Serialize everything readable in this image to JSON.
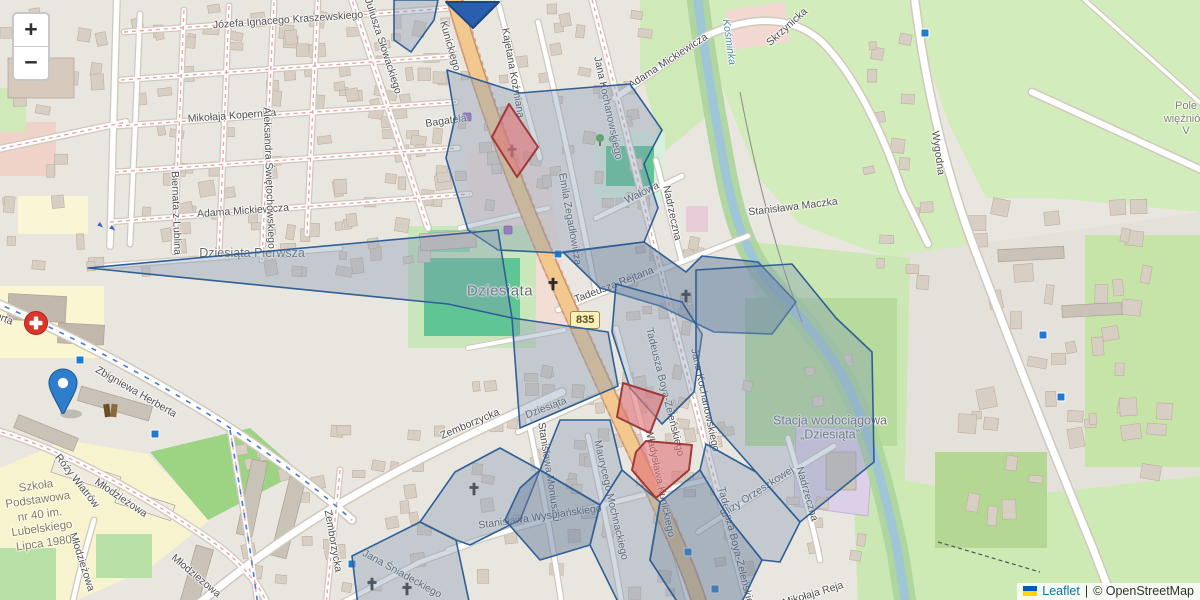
{
  "controls": {
    "zoom_in": "+",
    "zoom_out": "−"
  },
  "attribution": {
    "leaflet": "Leaflet",
    "separator": "|",
    "osm": "© OpenStreetMap"
  },
  "roads": {
    "shield_ref": "835"
  },
  "colors": {
    "overlay_stroke": "#2f5f96",
    "overlay_fill": "rgba(133,156,182,0.38)",
    "overlay_fill_dark": "rgba(104,128,158,0.5)",
    "red_stroke": "#a03a3a",
    "red_fill": "rgba(224,118,122,0.62)",
    "marker": "#2e7ecb",
    "arrow": "#2a5fae",
    "bus": "#1f7ad1"
  },
  "map_labels": [
    {
      "n": "street-kraszewskiego",
      "t": "Józefa Ignacego Kraszewskiego",
      "x": 288,
      "y": 20,
      "r": -4,
      "c": "st"
    },
    {
      "n": "street-kopernika",
      "t": "Mikołaja Kopernika",
      "x": 232,
      "y": 116,
      "r": -4,
      "c": "st"
    },
    {
      "n": "street-slowackiego",
      "t": "Juliusza Słowackiego",
      "x": 383,
      "y": 46,
      "r": 72,
      "c": "st"
    },
    {
      "n": "street-mickiewicza-w",
      "t": "Adama Mickiewicza",
      "x": 243,
      "y": 211,
      "r": -4,
      "c": "st"
    },
    {
      "n": "street-biernata",
      "t": "Biernata z Lublina",
      "x": 176,
      "y": 213,
      "r": 88,
      "c": "st"
    },
    {
      "n": "street-swietochowskiego",
      "t": "Aleksandra Świętochowskiego",
      "x": 269,
      "y": 178,
      "r": 88,
      "c": "st"
    },
    {
      "n": "place-dziesiata-pierwsza",
      "t": "Dziesiąta Pierwsza",
      "x": 252,
      "y": 253,
      "r": 0,
      "c": "pl2"
    },
    {
      "n": "place-dziesiata",
      "t": "Dziesiąta",
      "x": 500,
      "y": 291,
      "r": 0,
      "c": "pl"
    },
    {
      "n": "street-herberta",
      "t": "Zbigniewa Herberta",
      "x": 136,
      "y": 392,
      "r": 30,
      "c": "st"
    },
    {
      "n": "street-herberta-w",
      "t": "Zbigniewa Herberta",
      "x": -30,
      "y": 305,
      "r": 22,
      "c": "st"
    },
    {
      "n": "street-rozy-wiatrow",
      "t": "Róży Wiatrów",
      "x": 77,
      "y": 481,
      "r": 52,
      "c": "st"
    },
    {
      "n": "street-mlodziezowa-1",
      "t": "Młodzieżowa",
      "x": 121,
      "y": 498,
      "r": 34,
      "c": "st"
    },
    {
      "n": "street-mlodziezowa-2",
      "t": "Młodzieżowa",
      "x": 82,
      "y": 562,
      "r": 72,
      "c": "st"
    },
    {
      "n": "street-mlodziezowa-3",
      "t": "Młodzieżowa",
      "x": 196,
      "y": 576,
      "r": 40,
      "c": "st"
    },
    {
      "n": "poi-school-40",
      "t": "Szkoła\nPodstawowa\nnr 40 im.\nLubelskiego\nLipca 1980",
      "x": 40,
      "y": 515,
      "r": -8,
      "c": "sch"
    },
    {
      "n": "street-kunickiego-n",
      "t": "Kunickiego",
      "x": 450,
      "y": 46,
      "r": 74,
      "c": "st"
    },
    {
      "n": "street-kunickiego-s",
      "t": "Władysława Kunickiego",
      "x": 660,
      "y": 483,
      "r": 78,
      "c": "st"
    },
    {
      "n": "street-bagatela",
      "t": "Bagatela",
      "x": 446,
      "y": 121,
      "r": -8,
      "c": "st"
    },
    {
      "n": "street-kozmiana",
      "t": "Kajetana Koźmiana",
      "x": 513,
      "y": 73,
      "r": 80,
      "c": "st"
    },
    {
      "n": "street-kochanowskiego-n",
      "t": "Jana Kochanowskiego",
      "x": 608,
      "y": 108,
      "r": 78,
      "c": "st"
    },
    {
      "n": "street-kochanowskiego-s",
      "t": "Jana Kochanowskiego",
      "x": 705,
      "y": 400,
      "r": 78,
      "c": "st"
    },
    {
      "n": "street-mickiewicza-e",
      "t": "Adama Mickiewicza",
      "x": 668,
      "y": 61,
      "r": -33,
      "c": "st"
    },
    {
      "n": "river-label",
      "t": "Kośminka",
      "x": 729,
      "y": 42,
      "r": 82,
      "c": "wt"
    },
    {
      "n": "street-skrzynicka",
      "t": "Skrzynicka",
      "x": 787,
      "y": 27,
      "r": -42,
      "c": "st"
    },
    {
      "n": "street-maczka",
      "t": "Stanisława Maczka",
      "x": 793,
      "y": 207,
      "r": -7,
      "c": "st"
    },
    {
      "n": "street-walowa",
      "t": "Wałowa",
      "x": 642,
      "y": 193,
      "r": -26,
      "c": "st"
    },
    {
      "n": "street-nadrzeczna-n",
      "t": "Nadrzeczna",
      "x": 672,
      "y": 213,
      "r": 78,
      "c": "st"
    },
    {
      "n": "street-nadrzeczna-s",
      "t": "Nadrzeczna",
      "x": 807,
      "y": 494,
      "r": 74,
      "c": "st"
    },
    {
      "n": "street-zegadlowicza",
      "t": "Emila Zegadłowicza",
      "x": 570,
      "y": 219,
      "r": 80,
      "c": "st"
    },
    {
      "n": "street-rejtana",
      "t": "Tadeusza Rejtana",
      "x": 614,
      "y": 285,
      "r": -21,
      "c": "st"
    },
    {
      "n": "street-boya-n",
      "t": "Tadeusza Boya-Żeleńskiego",
      "x": 665,
      "y": 392,
      "r": 76,
      "c": "st"
    },
    {
      "n": "street-boya-s",
      "t": "Tadeusza Boya-Żeleńskiego",
      "x": 737,
      "y": 551,
      "r": 76,
      "c": "st"
    },
    {
      "n": "street-moniuszki",
      "t": "Stanisława Moniuszki",
      "x": 549,
      "y": 472,
      "r": 81,
      "c": "st"
    },
    {
      "n": "street-wyspianskiego",
      "t": "Stanisława Wyspiańskiego",
      "x": 540,
      "y": 517,
      "r": -8,
      "c": "st"
    },
    {
      "n": "street-mochnackiego",
      "t": "Maurycego Mochnackiego",
      "x": 611,
      "y": 500,
      "r": 77,
      "c": "st"
    },
    {
      "n": "street-sniadeckiego",
      "t": "Jana Śniadeckiego",
      "x": 402,
      "y": 574,
      "r": 29,
      "c": "st"
    },
    {
      "n": "street-zemborzycka-1",
      "t": "Zemborzycka",
      "x": 470,
      "y": 424,
      "r": -23,
      "c": "st"
    },
    {
      "n": "street-zemborzycka-2",
      "t": "Zemborzycka",
      "x": 333,
      "y": 541,
      "r": 80,
      "c": "st"
    },
    {
      "n": "street-dziesiata",
      "t": "Dziesiąta",
      "x": 546,
      "y": 408,
      "r": -21,
      "c": "st"
    },
    {
      "n": "street-orzeszkowej",
      "t": "Elizy Orzeszkowej",
      "x": 757,
      "y": 492,
      "r": -33,
      "c": "st"
    },
    {
      "n": "street-wygodna",
      "t": "Wygodna",
      "x": 938,
      "y": 153,
      "r": 82,
      "c": "st"
    },
    {
      "n": "street-reja",
      "t": "Mikołaja Reja",
      "x": 813,
      "y": 594,
      "r": -17,
      "c": "st"
    },
    {
      "n": "poi-waterworks",
      "t": "Stacja wodociągowa\n„Dziesiąta”",
      "x": 830,
      "y": 428,
      "r": 0,
      "c": "pl2"
    },
    {
      "n": "place-pole-wiezniow",
      "t": "Pole więźniów\nV",
      "x": 1186,
      "y": 119,
      "r": 0,
      "c": "fld"
    }
  ],
  "overlay": {
    "blue": [
      {
        "pts": [
          [
            394,
            0
          ],
          [
            438,
            0
          ],
          [
            434,
            20
          ],
          [
            411,
            52
          ],
          [
            394,
            40
          ]
        ]
      },
      {
        "pts": [
          [
            447,
            70
          ],
          [
            520,
            93
          ],
          [
            630,
            84
          ],
          [
            662,
            130
          ],
          [
            644,
            164
          ],
          [
            658,
            208
          ],
          [
            644,
            242
          ],
          [
            560,
            253
          ],
          [
            498,
            250
          ],
          [
            468,
            230
          ],
          [
            446,
            158
          ],
          [
            455,
            118
          ]
        ]
      },
      {
        "pts": [
          [
            88,
            268
          ],
          [
            498,
            230
          ],
          [
            512,
            318
          ],
          [
            448,
            304
          ]
        ]
      },
      {
        "pts": [
          [
            563,
            252
          ],
          [
            644,
            242
          ],
          [
            686,
            272
          ],
          [
            702,
            256
          ],
          [
            758,
            262
          ],
          [
            796,
            302
          ],
          [
            772,
            334
          ],
          [
            714,
            332
          ],
          [
            660,
            306
          ],
          [
            600,
            288
          ]
        ],
        "dark": true
      },
      {
        "pts": [
          [
            616,
            284
          ],
          [
            682,
            302
          ],
          [
            702,
            334
          ],
          [
            694,
            392
          ],
          [
            662,
            424
          ],
          [
            630,
            388
          ],
          [
            612,
            332
          ]
        ]
      },
      {
        "pts": [
          [
            696,
            270
          ],
          [
            792,
            264
          ],
          [
            836,
            318
          ],
          [
            872,
            352
          ],
          [
            874,
            462
          ],
          [
            800,
            522
          ],
          [
            756,
            472
          ],
          [
            712,
            422
          ],
          [
            696,
            352
          ]
        ]
      },
      {
        "pts": [
          [
            512,
            318
          ],
          [
            608,
            332
          ],
          [
            618,
            386
          ],
          [
            520,
            428
          ]
        ]
      },
      {
        "pts": [
          [
            352,
            556
          ],
          [
            420,
            522
          ],
          [
            456,
            540
          ],
          [
            470,
            606
          ],
          [
            358,
            606
          ]
        ]
      },
      {
        "pts": [
          [
            420,
            522
          ],
          [
            455,
            472
          ],
          [
            500,
            448
          ],
          [
            540,
            470
          ],
          [
            520,
            520
          ],
          [
            470,
            545
          ],
          [
            456,
            540
          ]
        ]
      },
      {
        "pts": [
          [
            520,
            488
          ],
          [
            540,
            470
          ],
          [
            600,
            505
          ],
          [
            590,
            545
          ],
          [
            540,
            560
          ],
          [
            505,
            520
          ]
        ],
        "dark": true
      },
      {
        "pts": [
          [
            560,
            420
          ],
          [
            610,
            420
          ],
          [
            622,
            470
          ],
          [
            600,
            505
          ],
          [
            540,
            470
          ]
        ]
      },
      {
        "pts": [
          [
            600,
            505
          ],
          [
            622,
            470
          ],
          [
            660,
            502
          ],
          [
            650,
            560
          ],
          [
            680,
            606
          ],
          [
            620,
            606
          ],
          [
            590,
            545
          ]
        ]
      },
      {
        "pts": [
          [
            650,
            560
          ],
          [
            660,
            502
          ],
          [
            700,
            470
          ],
          [
            730,
            520
          ],
          [
            762,
            560
          ],
          [
            740,
            606
          ],
          [
            680,
            606
          ]
        ],
        "dark": true
      },
      {
        "pts": [
          [
            730,
            520
          ],
          [
            700,
            470
          ],
          [
            706,
            444
          ],
          [
            756,
            472
          ],
          [
            800,
            522
          ],
          [
            780,
            562
          ],
          [
            762,
            560
          ]
        ]
      }
    ],
    "red": [
      {
        "pts": [
          [
            509,
            104
          ],
          [
            538,
            147
          ],
          [
            517,
            177
          ],
          [
            492,
            137
          ]
        ]
      },
      {
        "pts": [
          [
            623,
            383
          ],
          [
            664,
            396
          ],
          [
            650,
            433
          ],
          [
            617,
            417
          ]
        ]
      },
      {
        "pts": [
          [
            646,
            441
          ],
          [
            692,
            445
          ],
          [
            689,
            470
          ],
          [
            656,
            498
          ],
          [
            632,
            470
          ],
          [
            636,
            452
          ]
        ]
      }
    ]
  },
  "icons": {
    "bus_stops": [
      [
        80,
        360
      ],
      [
        155,
        434
      ],
      [
        558,
        254
      ],
      [
        352,
        564
      ],
      [
        688,
        552
      ],
      [
        715,
        589
      ],
      [
        925,
        33
      ],
      [
        1043,
        335
      ],
      [
        1061,
        397
      ]
    ],
    "crosses": [
      [
        553,
        284
      ],
      [
        686,
        296
      ],
      [
        512,
        151
      ],
      [
        474,
        489
      ],
      [
        372,
        584
      ],
      [
        407,
        589
      ]
    ],
    "trees": [
      [
        600,
        140
      ],
      [
        613,
        141
      ]
    ],
    "shops": [
      [
        467,
        117
      ],
      [
        508,
        230
      ]
    ],
    "books": [
      104,
      404
    ],
    "hospital": [
      36,
      323
    ],
    "marker_tip": [
      63,
      415
    ],
    "arrow": [
      [
        446,
        2
      ],
      [
        499,
        2
      ],
      [
        473,
        28
      ]
    ],
    "oneway": [
      [
        100,
        222
      ],
      [
        112,
        225
      ]
    ]
  }
}
